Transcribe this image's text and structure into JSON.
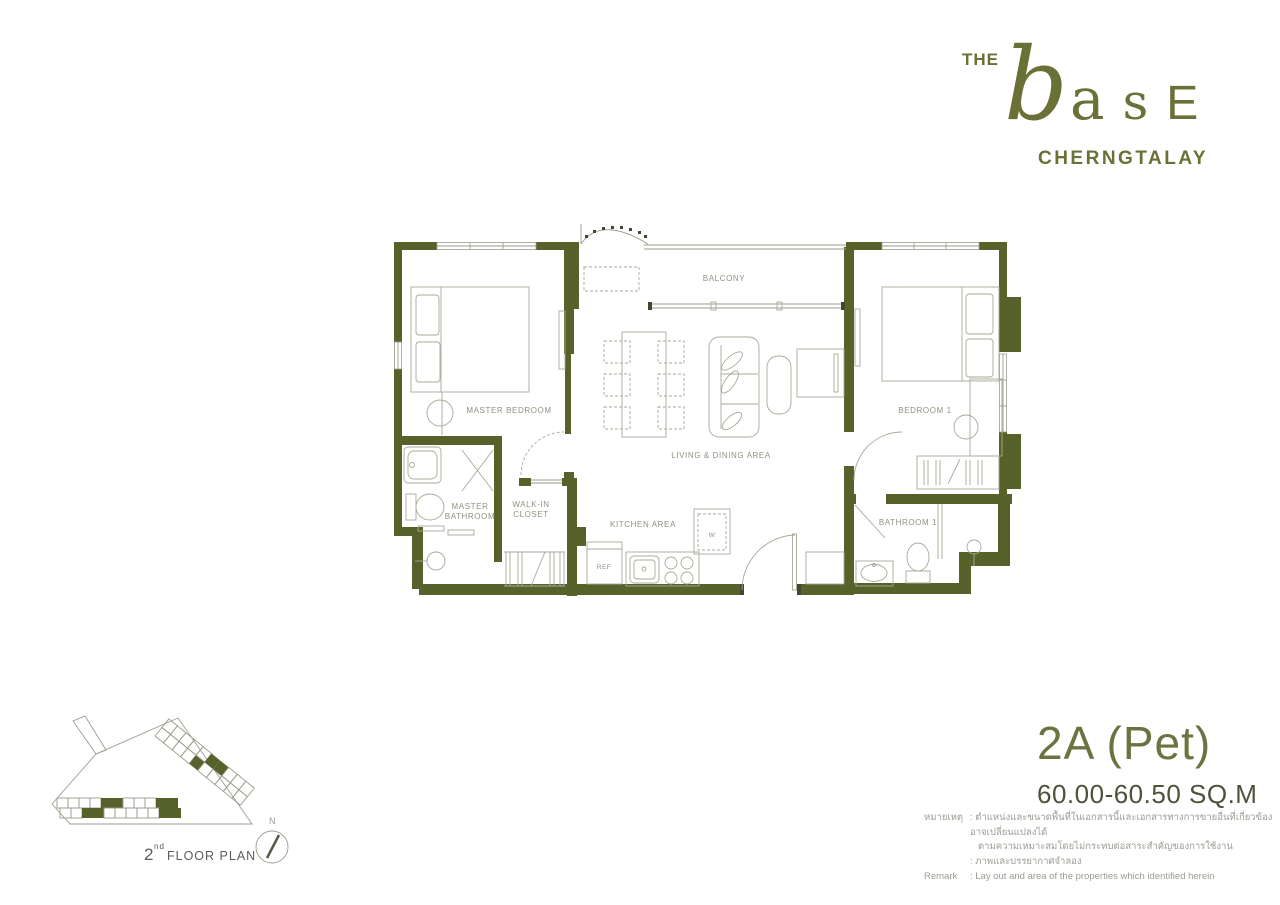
{
  "brand": {
    "the": "THE",
    "b": "b",
    "a": "a",
    "s": "s",
    "e": "E",
    "location": "CHERNGTALAY"
  },
  "unit": {
    "type": "2A (Pet)",
    "area": "60.00-60.50 SQ.M"
  },
  "plan": {
    "labels": {
      "master_bedroom": "MASTER BEDROOM",
      "bedroom1": "BEDROOM 1",
      "living_dining": "LIVING & DINING AREA",
      "kitchen": "KITCHEN AREA",
      "master_bath_l1": "MASTER",
      "master_bath_l2": "BATHROOM",
      "closet_l1": "WALK-IN",
      "closet_l2": "CLOSET",
      "bathroom1": "BATHROOM 1",
      "balcony": "BALCONY",
      "ref": "REF",
      "washer": "W"
    }
  },
  "site": {
    "floor_num": "2",
    "floor_sup": "nd",
    "floor_label": "FLOOR PLAN",
    "north": "N"
  },
  "remarks": {
    "label_thai": "หมายเหตุ",
    "line1": ": ตำแหน่งและขนาดพื้นที่ในเอกสารนี้และเอกสารทางการขายอื่นที่เกี่ยวข้อง อาจเปลี่ยนแปลงได้",
    "line2": "ตามความเหมาะสมโดยไม่กระทบต่อสาระสำคัญของการใช้งาน",
    "line3": ": ภาพและบรรยากาศจำลอง",
    "label_en": "Remark",
    "line_en": ": Lay out and area of the properties which identified herein"
  },
  "colors": {
    "wall": "#57622b",
    "brand": "#6b7036",
    "area_text": "#4d523a"
  }
}
